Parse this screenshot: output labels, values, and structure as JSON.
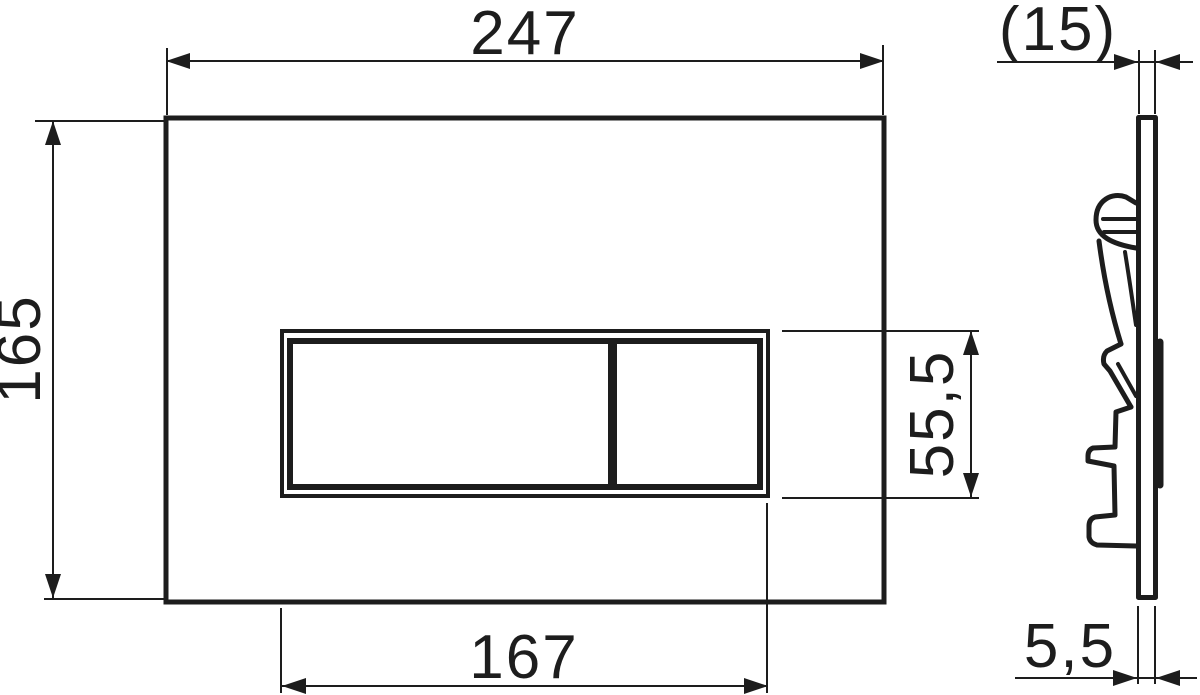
{
  "drawing": {
    "type": "technical-drawing",
    "subject": "dual-flush toilet actuator plate, front view and side profile with mounting clips",
    "units": "mm",
    "line_color": "#1d1d1d",
    "background_color": "#ffffff",
    "views": [
      {
        "id": "front-view",
        "description": "front view of flush plate with dual button window"
      },
      {
        "id": "side-view",
        "description": "side cross-section profile showing plate thickness, protruding button and mounting clips"
      }
    ],
    "dimensions": {
      "plate_width": "247",
      "plate_height": "165",
      "button_window_width": "167",
      "button_window_height": "55,5",
      "overall_depth_ref": "(15)",
      "plate_thickness": "5,5"
    }
  }
}
